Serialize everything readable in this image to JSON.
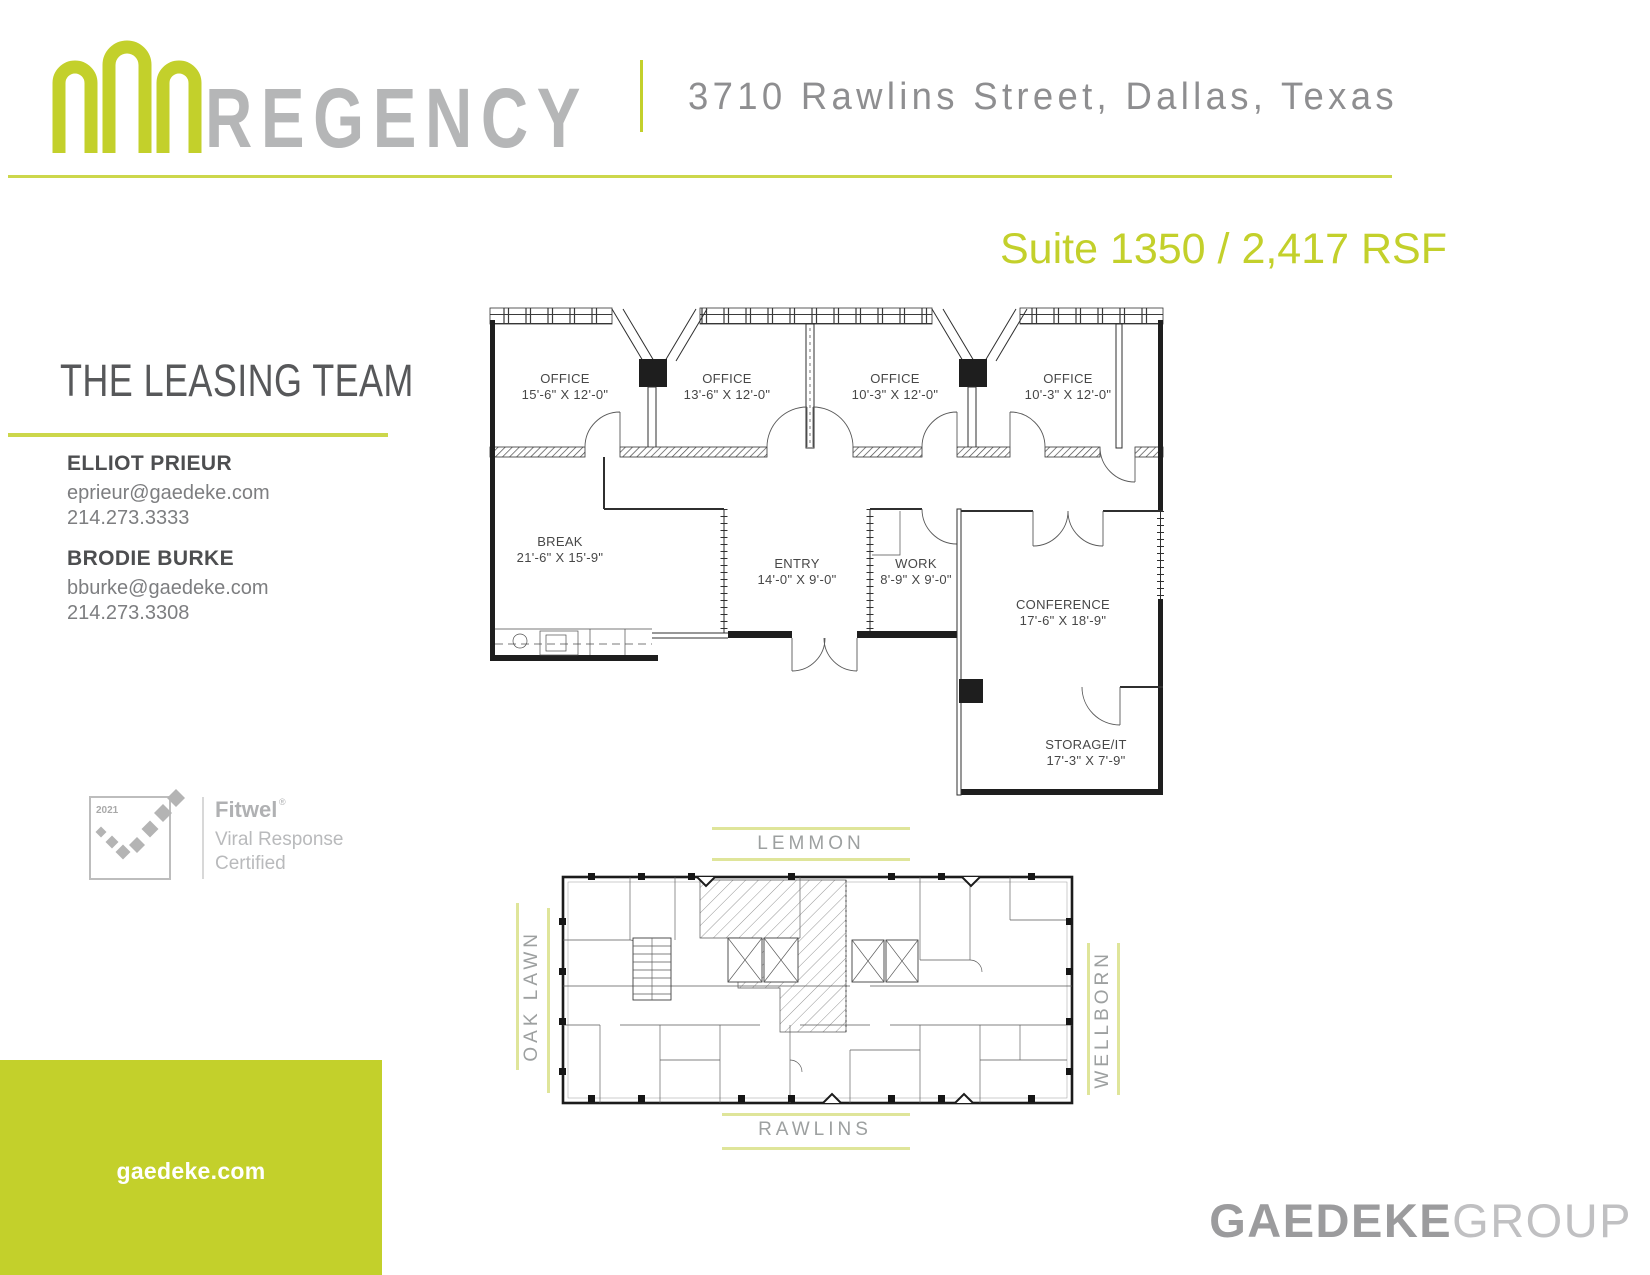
{
  "colors": {
    "accent": "#c3d02b",
    "accentLight": "#dfe59a",
    "accentLight2": "#ccd74b",
    "logoGray": "#b5b6b7",
    "addressGray": "#8e8e90",
    "headingGray": "#57585a",
    "nameGray": "#4d4e50",
    "textGray": "#7d7e80",
    "streetGray": "#9da0a0",
    "fitwelGray": "#b0b1b3",
    "brandBold": "#9b9b9d",
    "brandLight": "#c0c0c2"
  },
  "header": {
    "brand": "REGENCY",
    "address": "3710 Rawlins Street, Dallas, Texas"
  },
  "suite": {
    "title": "Suite 1350 / 2,417 RSF"
  },
  "leasing_team": {
    "heading": "THE LEASING TEAM",
    "contacts": [
      {
        "name": "ELLIOT PRIEUR",
        "email": "eprieur@gaedeke.com",
        "phone": "214.273.3333"
      },
      {
        "name": "BRODIE BURKE",
        "email": "bburke@gaedeke.com",
        "phone": "214.273.3308"
      }
    ]
  },
  "fitwel": {
    "year": "2021",
    "brand": "Fitwel",
    "reg": "®",
    "cert_line1": "Viral Response",
    "cert_line2": "Certified"
  },
  "floor_plan": {
    "rooms": [
      {
        "name": "OFFICE",
        "dims": "15'-6\" X 12'-0\""
      },
      {
        "name": "OFFICE",
        "dims": "13'-6\" X 12'-0\""
      },
      {
        "name": "OFFICE",
        "dims": "10'-3\" X 12'-0\""
      },
      {
        "name": "OFFICE",
        "dims": "10'-3\" X 12'-0\""
      },
      {
        "name": "BREAK",
        "dims": "21'-6\" X 15'-9\""
      },
      {
        "name": "ENTRY",
        "dims": "14'-0\" X 9'-0\""
      },
      {
        "name": "WORK",
        "dims": "8'-9\" X 9'-0\""
      },
      {
        "name": "CONFERENCE",
        "dims": "17'-6\" X 18'-9\""
      },
      {
        "name": "STORAGE/IT",
        "dims": "17'-3\" X 7'-9\""
      }
    ]
  },
  "key_plan": {
    "streets": {
      "top": "LEMMON",
      "bottom": "RAWLINS",
      "left": "OAK LAWN",
      "right": "WELLBORN"
    }
  },
  "footer": {
    "website": "gaedeke.com",
    "brand_bold": "GAEDEKE",
    "brand_light": "GROUP"
  }
}
